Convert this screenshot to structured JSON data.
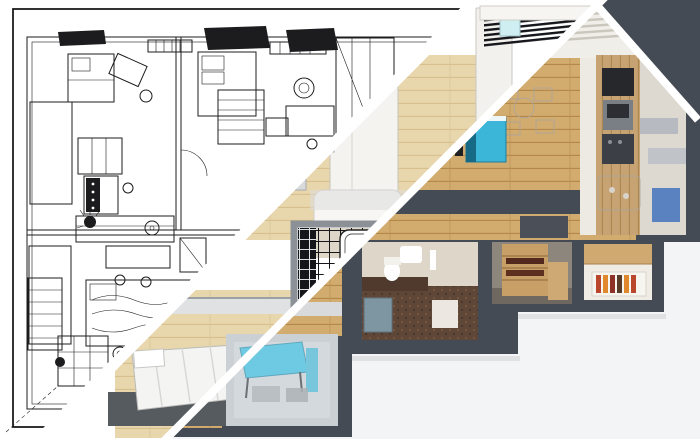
{
  "image": {
    "title": "Apartment plan: wireframe sketch to 3D render transition",
    "type": "architectural-visualization",
    "zones": [
      {
        "id": "sketch",
        "label": "wireframe line-drawing plan"
      },
      {
        "id": "partial",
        "label": "grayscale draft render band"
      },
      {
        "id": "render",
        "label": "full color 3D top-down render"
      }
    ],
    "rooms": [
      "living-room",
      "kitchen",
      "bathroom",
      "bedroom",
      "wardrobe",
      "entry-hall",
      "balcony"
    ]
  },
  "palette": {
    "paper": "#ffffff",
    "outside": "#f3f4f6",
    "ink": "#1c1c1e",
    "wall_dark": "#454b54",
    "wall_mid": "#8b9197",
    "wall_light": "#dcdcda",
    "wood": "#d2ab6f",
    "wood_pale": "#e8d7ad",
    "wood_wall": "#c7a272",
    "wood_shelf": "#c89f66",
    "sofa_gray": "#d9dadb",
    "white_furn": "#f4f2ee",
    "cyan": "#3cb6d8",
    "blue_panel": "#5b82c0",
    "glass": "#cfeef2",
    "tile_beige": "#ded6c9",
    "mosaic_brown": "#5f4738",
    "tub_blue": "#7e95a2",
    "balcony_haze": "#b9c0c6",
    "rug_tan": "#cbb49a",
    "rug_dark": "#565b60",
    "appliance_dark": "#26282c",
    "appliance_gray": "#7a7f86",
    "books": [
      "#b9472c",
      "#e0892c",
      "#8e3126",
      "#5a3b28"
    ]
  }
}
